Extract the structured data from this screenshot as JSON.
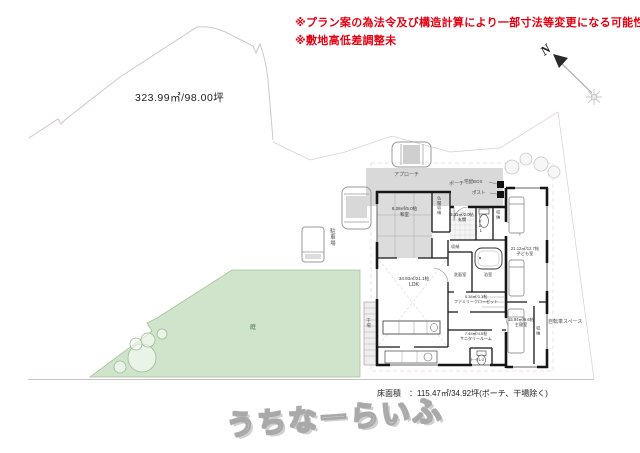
{
  "notices": {
    "line1": "※プラン案の為法令及び構造計算により一部寸法等変更になる可能性有",
    "line2": "※敷地高低差調整未"
  },
  "site": {
    "area_label": "323.99㎡/98.00坪",
    "garden_label": "庭",
    "parking_label": "駐車場",
    "bicycle_space_label": "自転車スペース"
  },
  "compass": {
    "north_label": "N"
  },
  "plan": {
    "approach_label": "アプローチ",
    "porch_label": "ポーチ",
    "delivery_box_label": "宅配BOX",
    "post_label": "ポスト",
    "drying_label": "干場",
    "rooms": {
      "washitsu": {
        "size": "8.28㎡/5.0帖",
        "name": "和室"
      },
      "butsudan_closet": {
        "name": "仏間収納"
      },
      "genkan": {
        "size": "3.31㎡/2.0帖",
        "name": "玄関"
      },
      "toilet1": {
        "name": "トイレ1"
      },
      "hall_closet": {
        "name": "収納"
      },
      "kids_room": {
        "size": "21.12㎡/12.7帖",
        "name": "子ども室"
      },
      "washroom_closet": {
        "name": "収納"
      },
      "washroom": {
        "name": "洗面室"
      },
      "bathroom": {
        "name": "浴室"
      },
      "ldk": {
        "size": "34.93㎡/21.1帖",
        "name": "LDK"
      },
      "family_closet": {
        "size": "5.38㎡/3.3帖",
        "name": "ファミリークローゼット"
      },
      "sanitary_room": {
        "size": "7.45㎡/4.5帖",
        "name": "サニタリールーム"
      },
      "toilet2": {
        "name": "トイレ2"
      },
      "master_bedroom": {
        "size": "15.94㎡/9.6帖",
        "name": "主寝室"
      },
      "bedroom_closet": {
        "name": "収納"
      }
    }
  },
  "footer": {
    "floor_area_label": "床面積　：115.47㎡/34.92坪(ポーチ、干場除く)"
  },
  "watermark": {
    "text": "うちなーらいふ"
  },
  "colors": {
    "notice_red": "#e60012",
    "garden_green": "#cfe4ca",
    "porch_gray": "#d9d9d9",
    "wall_black": "#161616"
  }
}
